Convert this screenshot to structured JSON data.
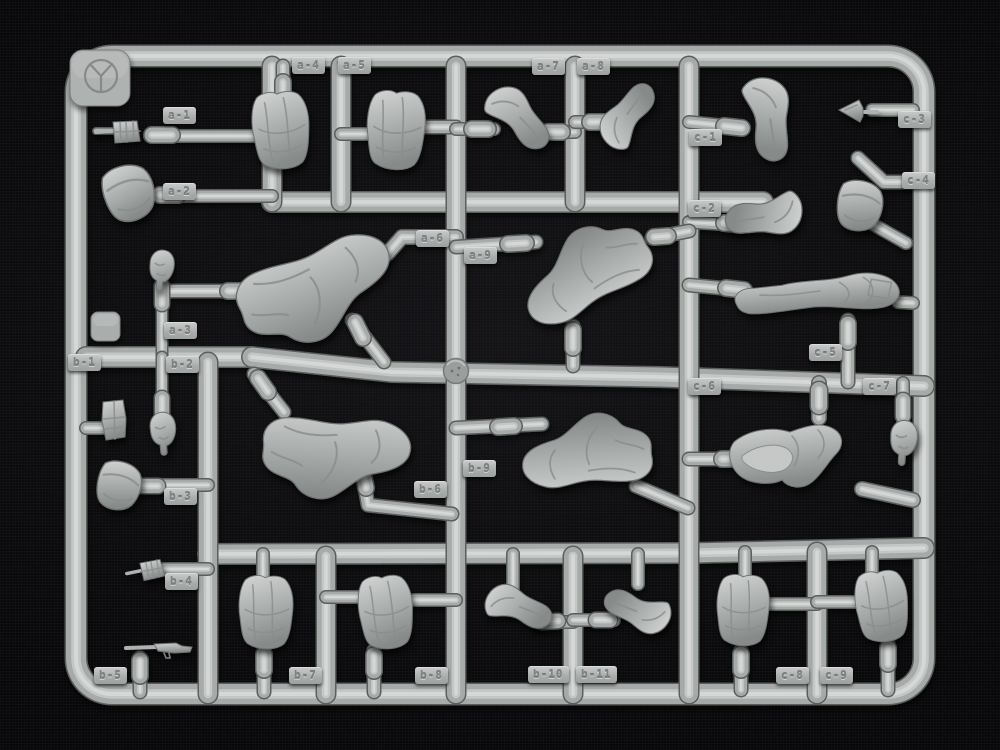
{
  "sprue": {
    "logo_mark": "Y",
    "plastic_color": "#aeb2b0",
    "background_color": "#08080a",
    "label_rows": [
      "a",
      "b",
      "c"
    ]
  },
  "labels": [
    "a-1",
    "a-2",
    "a-3",
    "a-4",
    "a-5",
    "a-6",
    "a-7",
    "a-8",
    "a-9",
    "b-1",
    "b-2",
    "b-3",
    "b-4",
    "b-5",
    "b-6",
    "b-7",
    "b-8",
    "b-9",
    "b-10",
    "b-11",
    "c-1",
    "c-2",
    "c-3",
    "c-4",
    "c-5",
    "c-6",
    "c-7",
    "c-8",
    "c-9"
  ],
  "parts": {
    "a-1": "small-equipment",
    "a-2": "pouch",
    "a-3": "head",
    "a-4": "torso",
    "a-5": "torso",
    "a-6": "bent-legs-torso",
    "a-7": "bent-arm",
    "a-8": "raised-arm",
    "a-9": "bent-legs",
    "b-1": "ammo-pouches",
    "b-2": "head",
    "b-3": "pouch",
    "b-4": "small-equipment",
    "b-5": "rifle",
    "b-6": "bent-legs",
    "b-7": "torso",
    "b-8": "torso",
    "b-9": "bent-legs",
    "b-10": "bent-arm",
    "b-11": "bent-arm",
    "c-1": "bent-arm",
    "c-2": "bent-arm",
    "c-3": "small-part",
    "c-4": "pouch",
    "c-5": "lying-legs",
    "c-6": "seated-legs",
    "c-7": "head",
    "c-8": "torso",
    "c-9": "torso"
  }
}
